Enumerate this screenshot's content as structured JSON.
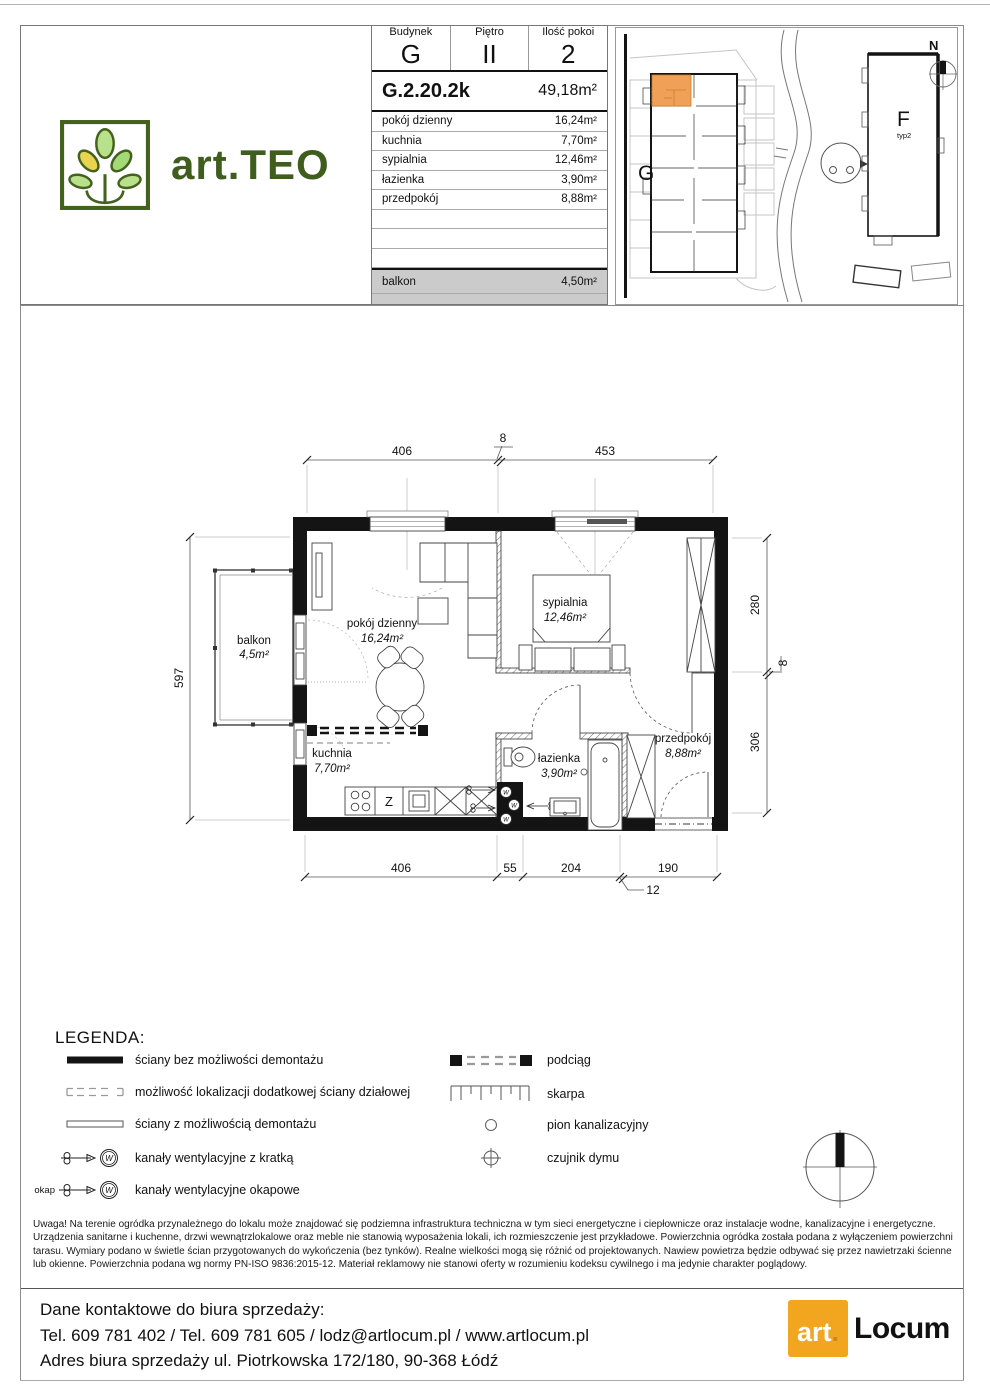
{
  "header": {
    "brand": "art.TEO",
    "table": {
      "cols": [
        {
          "label": "Budynek",
          "value": "G"
        },
        {
          "label": "Piętro",
          "value": "II"
        },
        {
          "label": "Ilość pokoi",
          "value": "2"
        }
      ],
      "unit_code": "G.2.20.2k",
      "unit_area": "49,18m²",
      "rooms": [
        {
          "name": "pokój dzienny",
          "area": "16,24m²"
        },
        {
          "name": "kuchnia",
          "area": "7,70m²"
        },
        {
          "name": "sypialnia",
          "area": "12,46m²"
        },
        {
          "name": "łazienka",
          "area": "3,90m²"
        },
        {
          "name": "przedpokój",
          "area": "8,88m²"
        }
      ],
      "balcony_name": "balkon",
      "balcony_area": "4,50m²"
    }
  },
  "siteplan": {
    "g": "G",
    "f": "F",
    "f_sub": "typ2",
    "n": "N"
  },
  "plan": {
    "labels": {
      "living_name": "pokój dzienny",
      "living_area": "16,24m²",
      "bedroom_name": "sypialnia",
      "bedroom_area": "12,46m²",
      "kitchen_name": "kuchnia",
      "kitchen_area": "7,70m²",
      "bath_name": "łazienka",
      "bath_area": "3,90m²",
      "hall_name": "przedpokój",
      "hall_area": "8,88m²",
      "balcony_name": "balkon",
      "balcony_area": "4,5m²"
    },
    "dims": {
      "top": [
        "406",
        "8",
        "453"
      ],
      "left": [
        "597"
      ],
      "right": [
        "280",
        "8",
        "306"
      ],
      "bottom": [
        "406",
        "55",
        "204",
        "190",
        "12"
      ]
    },
    "kitchen_z": "Z",
    "vent_w": "W"
  },
  "legend": {
    "title": "LEGENDA:",
    "items_left": [
      "ściany bez możliwości demontażu",
      "możliwość lokalizacji dodatkowej ściany działowej",
      "ściany z możliwością demontażu",
      "kanały wentylacyjne z kratką",
      "kanały wentylacyjne okapowe"
    ],
    "items_right": [
      "podciąg",
      "skarpa",
      "pion kanalizacyjny",
      "czujnik dymu"
    ],
    "okap": "okap",
    "w": "W"
  },
  "disclaimer": {
    "p1": "Uwaga! Na terenie ogródka przynależnego do lokalu może znajdować się podziemna infrastruktura techniczna w tym sieci energetyczne i ciepłownicze oraz instalacje wodne, kanalizacyjne i energetyczne.",
    "p2": "Urządzenia sanitarne i kuchenne, drzwi wewnątrzlokalowe oraz meble nie stanowią wyposażenia lokali, ich rozmieszczenie jest przykładowe. Powierzchnia ogródka została podana z wyłączeniem powierzchni tarasu. Wymiary podano w świetle ścian przygotowanych do wykończenia (bez tynków). Realne wielkości mogą się różnić od projektowanych. Nawiew powietrza będzie odbywać się przez nawietrzaki ścienne lub okienne. Powierzchnia podana wg normy PN-ISO 9836:2015-12. Materiał reklamowy nie stanowi oferty w rozumieniu kodeksu cywilnego i ma jedynie charakter poglądowy."
  },
  "footer": {
    "lines": [
      "Dane kontaktowe do biura sprzedaży:",
      "Tel. 609 781 402 / Tel. 609 781 605 / lodz@artlocum.pl / www.artlocum.pl",
      "Adres biura sprzedaży ul. Piotrkowska 172/180, 90-368 Łódź"
    ],
    "logo_art": "art",
    "logo_dot": ".",
    "logo_locum": "Locum"
  },
  "colors": {
    "accent_orange": "#f0a057",
    "brand_green": "#44611d",
    "locum_orange": "#f2a51f",
    "table_gray": "#cbcbcb",
    "wall": "#141414"
  }
}
